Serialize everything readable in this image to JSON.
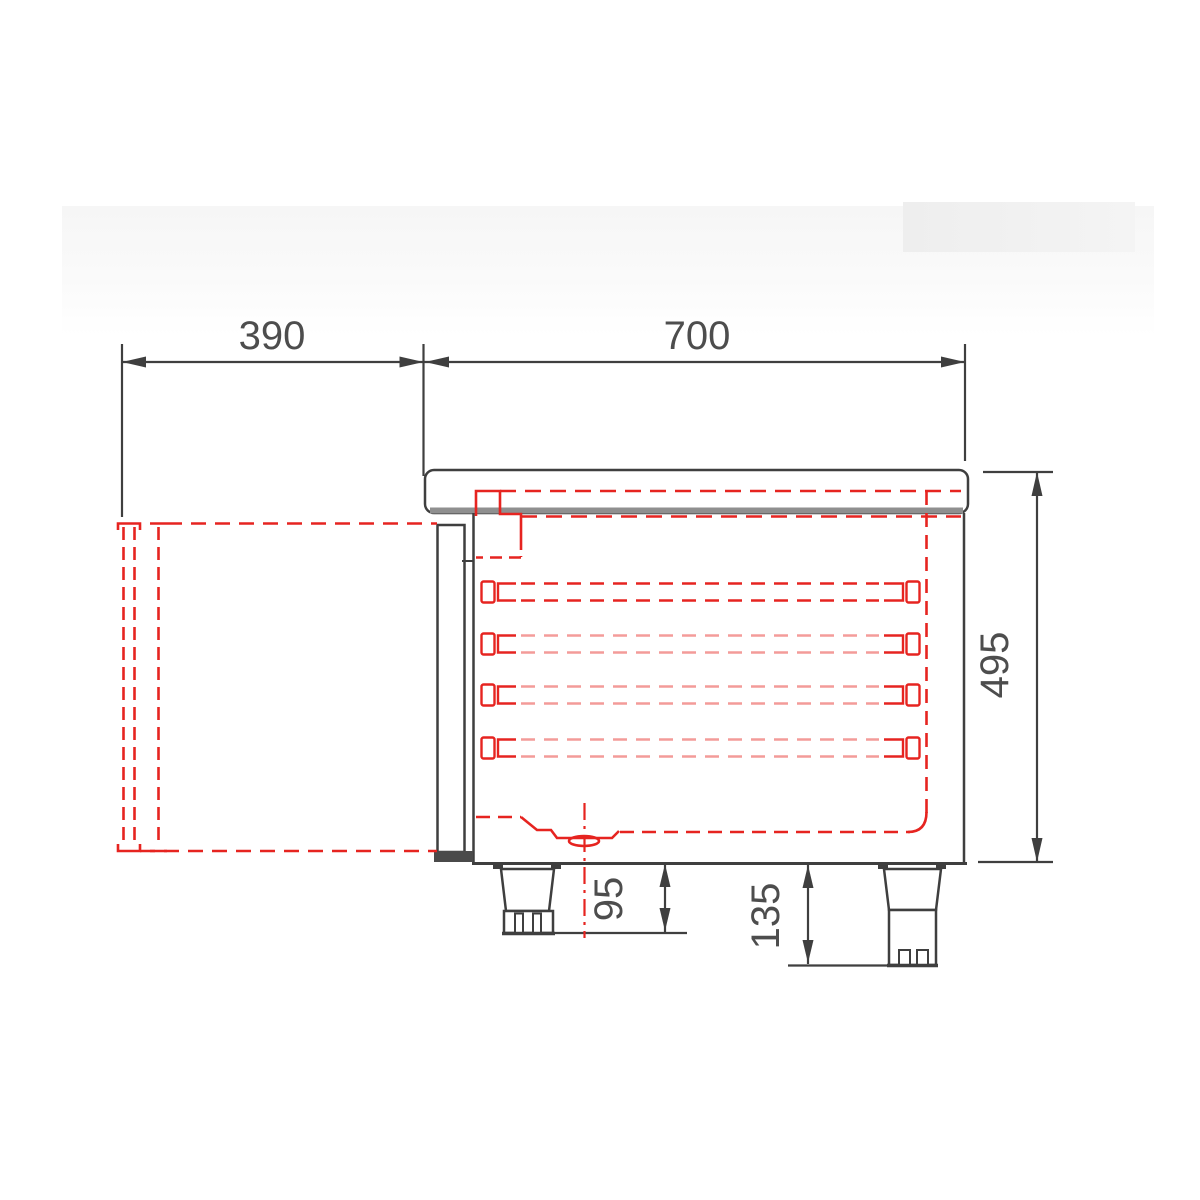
{
  "drawing": {
    "title": "refrigerated-counter-side-section",
    "dimensions": {
      "door_open_depth": "390",
      "body_depth": "700",
      "body_height": "495",
      "foot_height_min": "95",
      "foot_height_max": "135"
    },
    "rail_count": 4,
    "colors": {
      "outline": "#3f3f3f",
      "hidden_red": "#e62420",
      "worktop_shadow": "#8f8f8f",
      "background": "#ffffff",
      "dim_text": "#4d4d4d"
    }
  }
}
